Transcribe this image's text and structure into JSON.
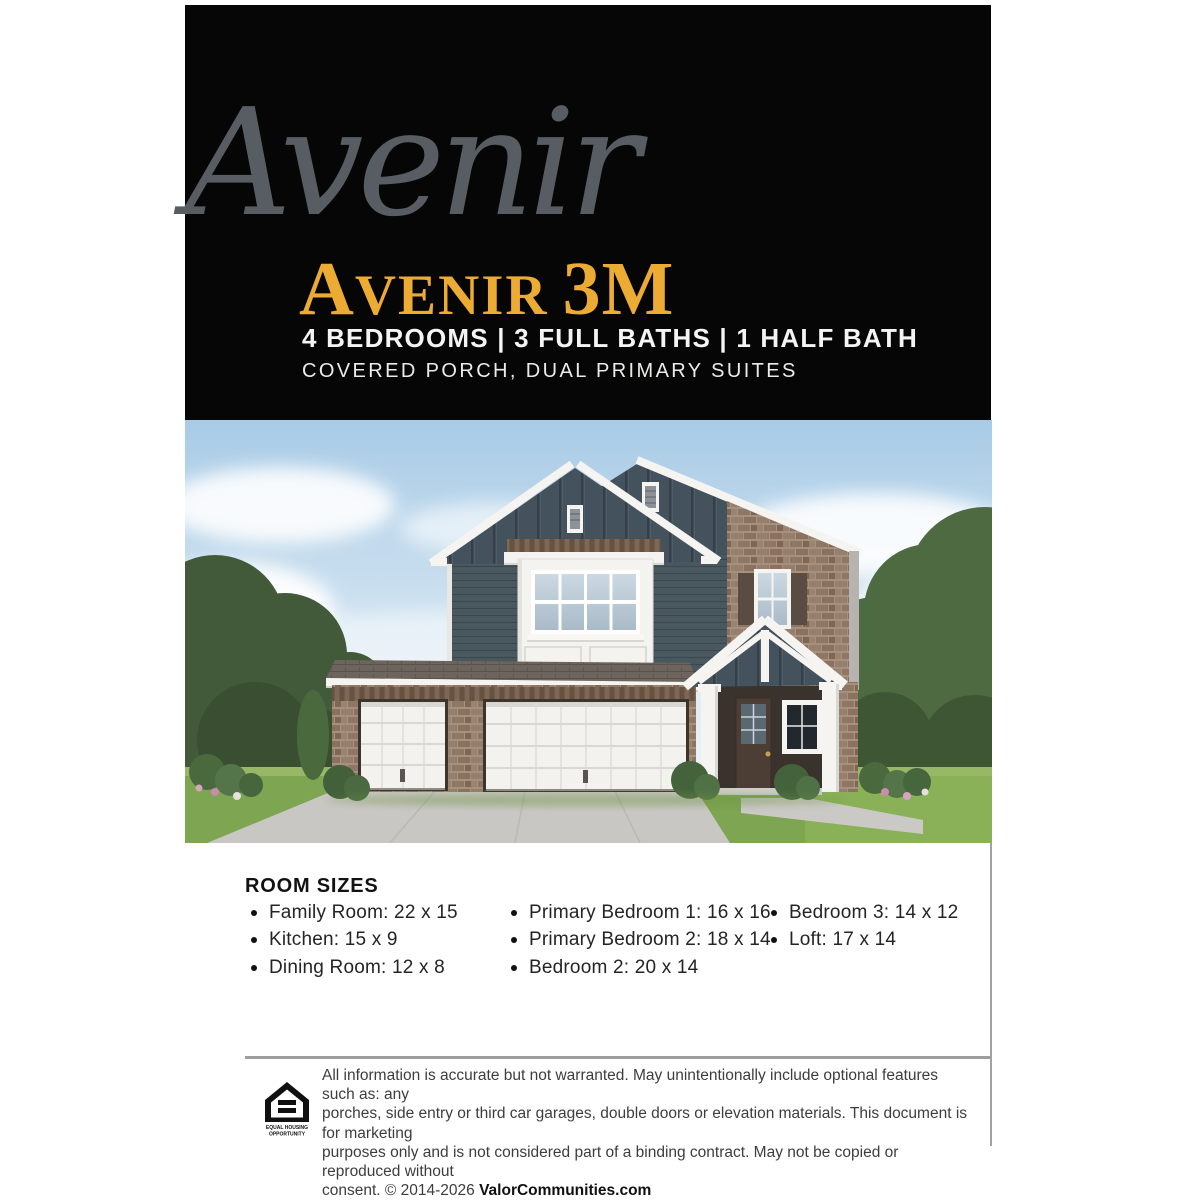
{
  "header": {
    "brand_script": "Avenir",
    "title_initial": "A",
    "title_rest": "VENIR",
    "title_suffix": "3M",
    "specs_line": "4 BEDROOMS | 3 FULL BATHS | 1 HALF BATH",
    "features_line": "COVERED PORCH, DUAL PRIMARY SUITES"
  },
  "room_sizes": {
    "heading": "ROOM SIZES",
    "columns": [
      {
        "items": [
          "Family Room: 22 x 15",
          "Kitchen: 15 x 9",
          "Dining Room: 12 x 8"
        ]
      },
      {
        "items": [
          "Primary Bedroom 1: 16 x 16",
          "Primary Bedroom 2: 18 x 14",
          "Bedroom 2: 20 x 14"
        ]
      },
      {
        "items": [
          "Bedroom 3: 14 x 12",
          "Loft: 17 x 14"
        ]
      }
    ]
  },
  "footer": {
    "logo_caption_line1": "EQUAL HOUSING",
    "logo_caption_line2": "OPPORTUNITY",
    "disclaimer_lines": [
      "All information is accurate but not warranted. May unintentionally include optional features such as: any",
      "porches, side entry or third car garages, double doors or elevation materials. This document is for marketing",
      "purposes only and is not considered part of a binding contract. May not be copied or reproduced without",
      "consent. © 2014-2026 "
    ],
    "website": "ValorCommunities.com"
  },
  "palette": {
    "header_bg": "#060606",
    "accent_gold": "#ecab33",
    "script_gray": "#575d63",
    "divider_gray": "#9e9e9e",
    "siding_blue": "#47565f",
    "brick_tan": "#97816f",
    "trim_white": "#f5f4f1"
  }
}
